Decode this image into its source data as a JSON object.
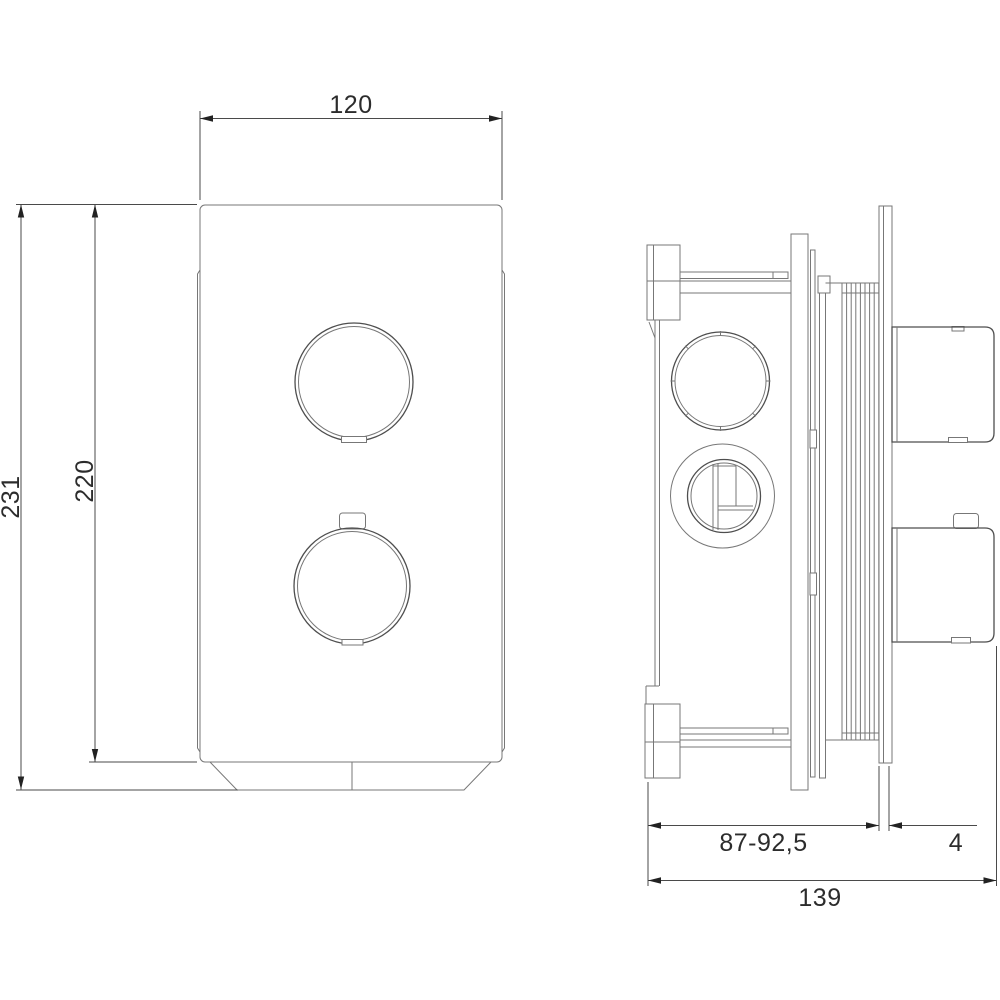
{
  "drawing": {
    "kind": "technical dimension drawing, front view and side view of concealed thermostatic shower mixer trim"
  },
  "labels": {
    "front_width": "120",
    "front_total_height": "231",
    "front_plate_height": "220",
    "side_depth_adjustable": "87-92,5",
    "side_plate_thickness": "4",
    "side_total_depth": "139"
  },
  "colors": {
    "background": "#ffffff",
    "object_line": "#777777",
    "knob_line": "#4e4e4e",
    "dimension_line": "#4a4a4a",
    "dimension_text": "#2c2c2c"
  }
}
